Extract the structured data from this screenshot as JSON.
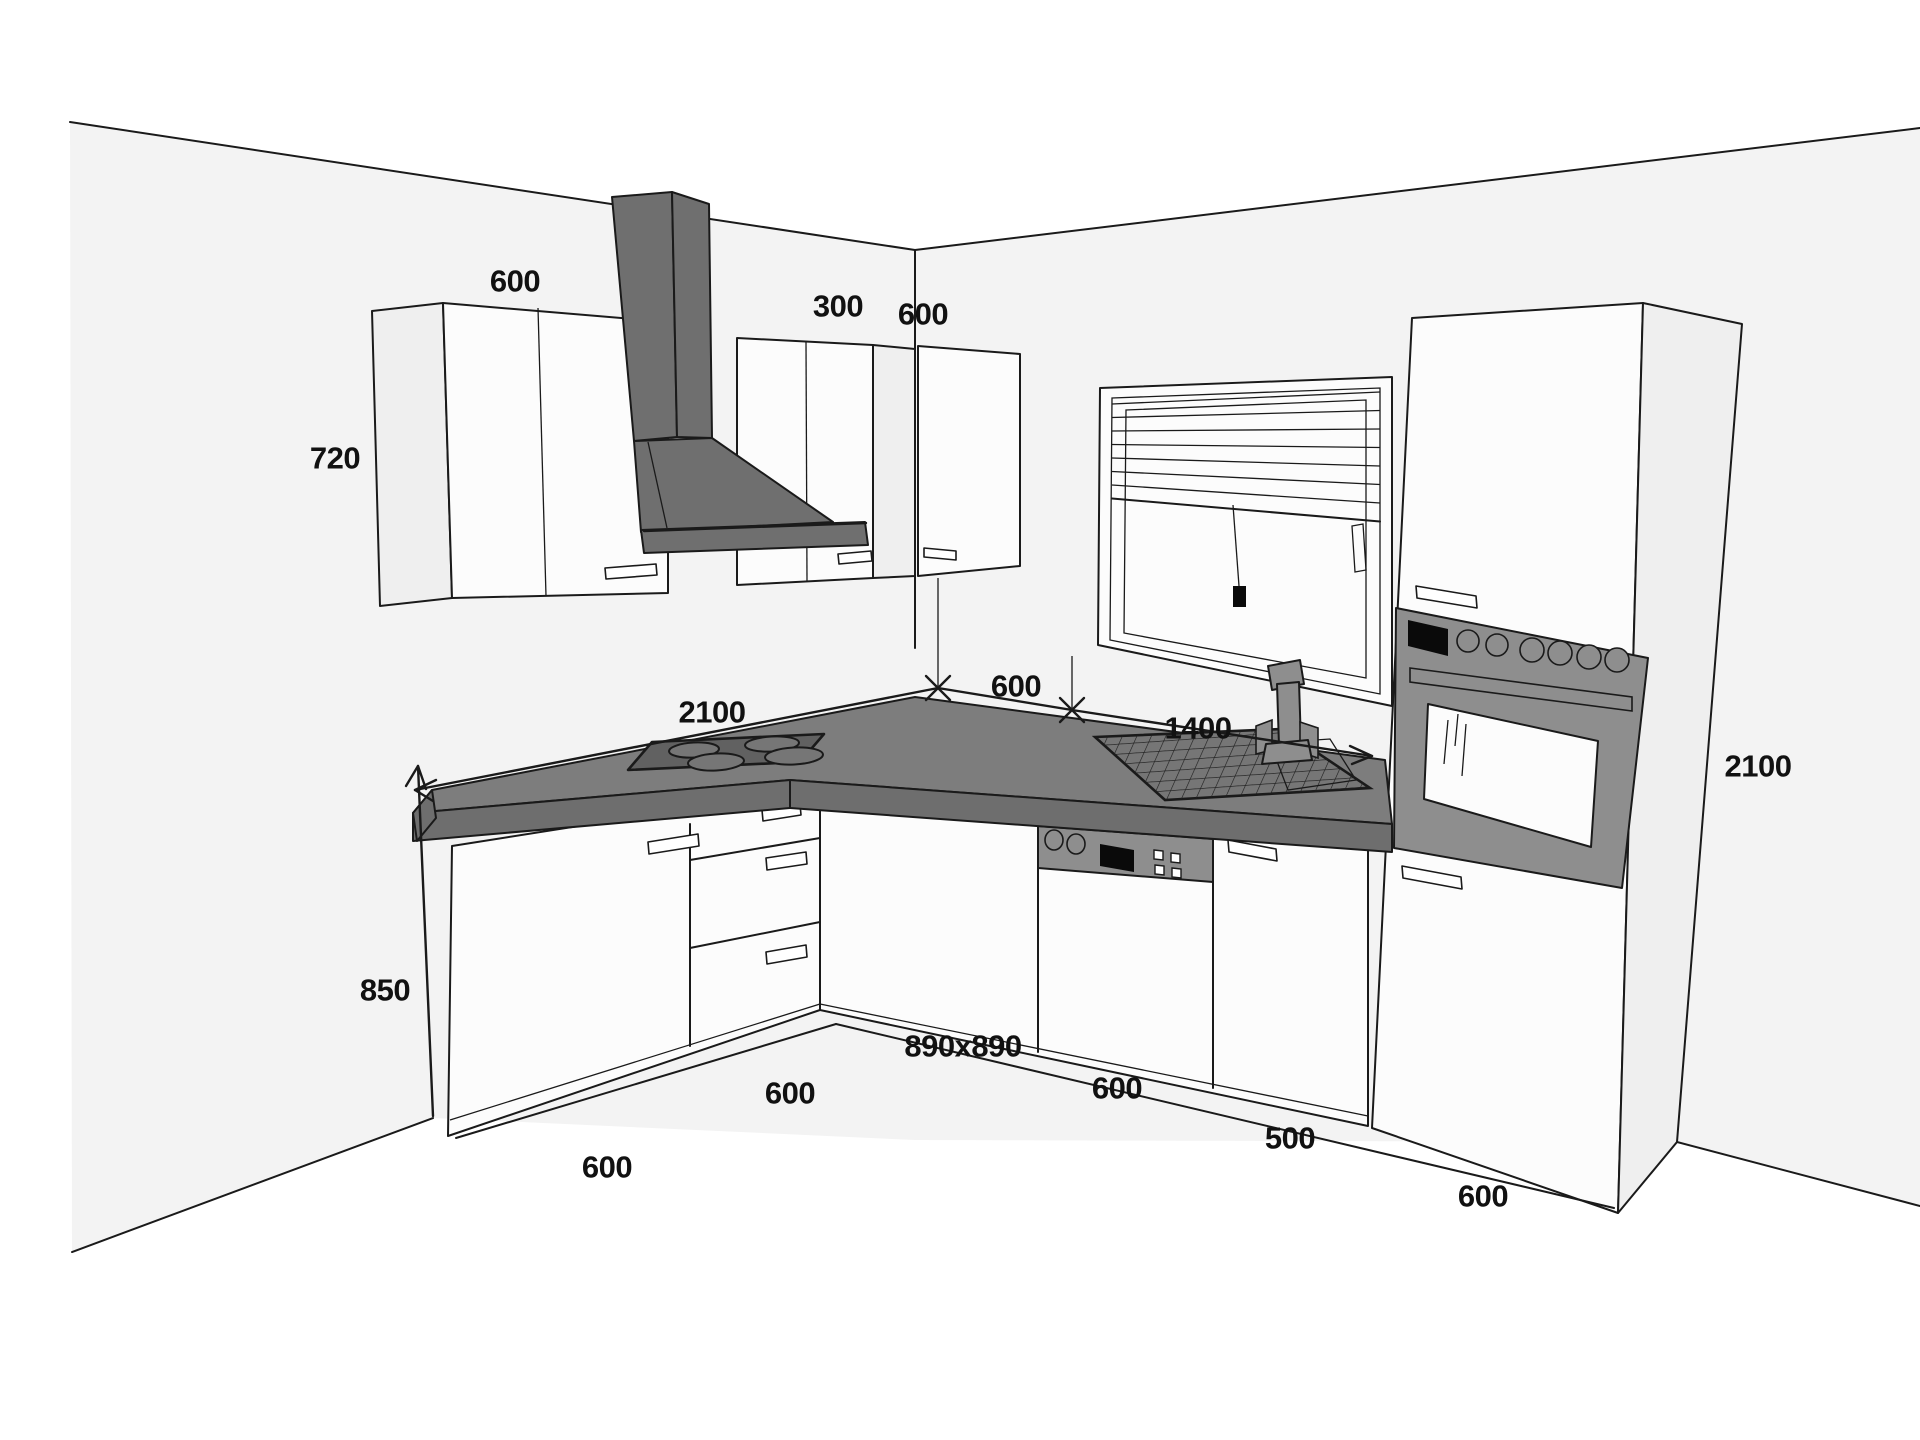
{
  "page": {
    "title": "Kitchen 3D layout drawing with dimensions (mm)"
  },
  "colors": {
    "wall": "#f3f3f3",
    "floor": "#ffffff",
    "line": "#1a1a1a",
    "cab": "#fcfcfc",
    "cabside": "#efefef",
    "hood": "#6f6f6f",
    "appliance": "#8e8e8e",
    "countertop": "#7d7d7d",
    "counterface": "#6e6e6e",
    "cooktop": "#616161",
    "burner": "#767676",
    "label": "#111111"
  },
  "labels": [
    {
      "id": "wall-cabinet-width",
      "text": "600"
    },
    {
      "id": "wall-cabinet-height",
      "text": "720"
    },
    {
      "id": "corner-wall-cabinet-width",
      "text": "300"
    },
    {
      "id": "right-wall-cabinet-width",
      "text": "600"
    },
    {
      "id": "left-counter-length",
      "text": "2100"
    },
    {
      "id": "corner-counter-width",
      "text": "600"
    },
    {
      "id": "right-counter-length",
      "text": "1400"
    },
    {
      "id": "tall-cabinet-height",
      "text": "2100"
    },
    {
      "id": "base-cabinet-height",
      "text": "850"
    },
    {
      "id": "base-cabinet-1-width",
      "text": "600"
    },
    {
      "id": "drawer-unit-width",
      "text": "600"
    },
    {
      "id": "corner-base-cabinet-size",
      "text": "890x890"
    },
    {
      "id": "dishwasher-width",
      "text": "600"
    },
    {
      "id": "mid-cabinet-width",
      "text": "500"
    },
    {
      "id": "tall-cabinet-width",
      "text": "600"
    }
  ]
}
